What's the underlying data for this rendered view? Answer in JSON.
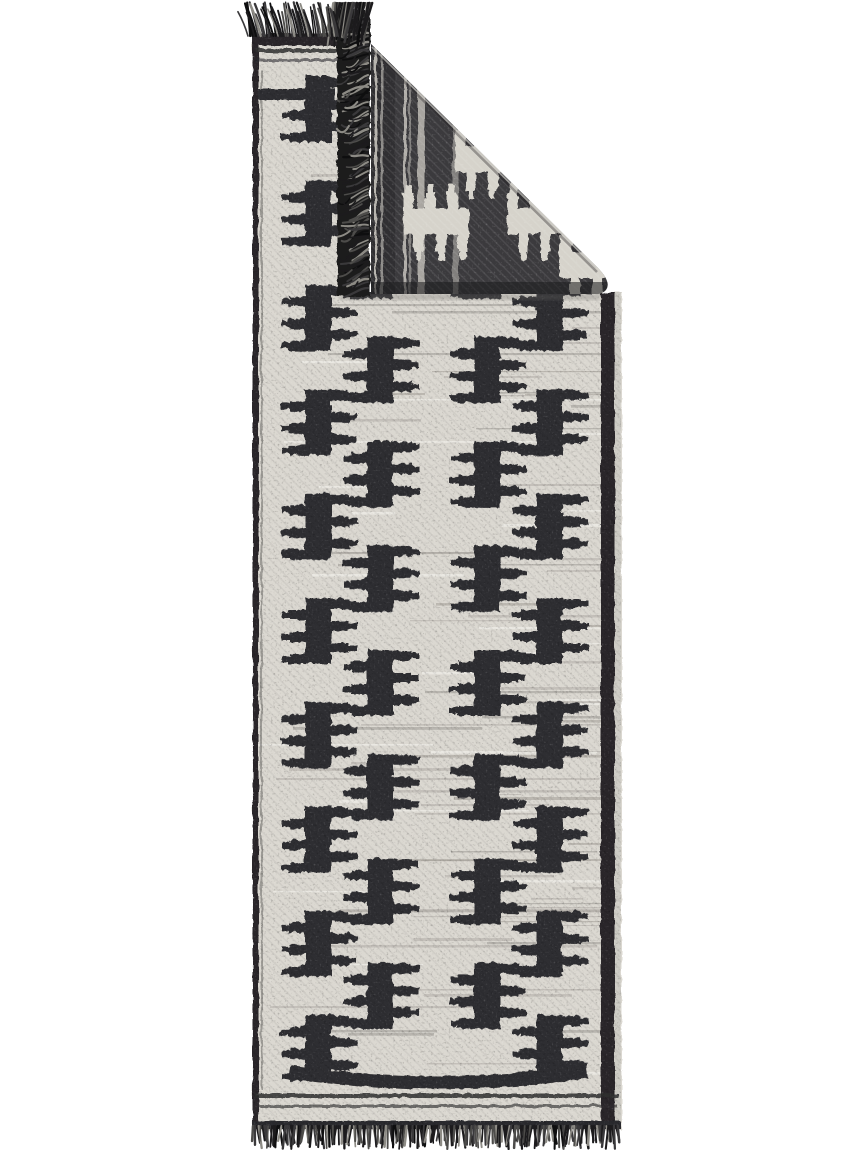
{
  "scene": {
    "type": "product-photo",
    "subject": "Flat-woven black and white kilim runner rug with geometric stepped comb motifs, top corner folded over showing the dark reverse side, fringed ends",
    "background_color": "#ffffff"
  },
  "colors": {
    "front_base": "#dbd8d1",
    "motif_dark": "#2f2e30",
    "back_base": "#3b3a3d",
    "back_shade": "#28272a",
    "back_motif_cream": "#d6d3cb",
    "border_dark": "#29282a",
    "braid_dark": "#2c2b2d",
    "fringe_dark": "#1c1b1d",
    "fringe_mid": "#3a393b",
    "fringe_soft": "#4d4c4a",
    "fringe_light": "#8d8b85",
    "edge_highlight": "#c6c4bf",
    "edge_sliver": "#cfcdc6",
    "streak_grey": "#a8a59d",
    "streak_light": "#f3f1eb",
    "streak_mid": "#8b8880",
    "streak_dark": "#66645f",
    "fold_shadow": "#6b6965"
  },
  "rug": {
    "left": 252,
    "right": 621,
    "top_fabric": 33,
    "bottom_fabric": 1129,
    "left_strip_right": 352,
    "fold": {
      "tip_x": 371,
      "tip_y": 44,
      "hyp_end_x": 597,
      "hyp_end_y": 267,
      "bottom_y": 294,
      "fringe_band": {
        "x": 336,
        "y": 9,
        "w": 33,
        "h": 286
      }
    },
    "borders": {
      "left_w": 6,
      "right_x": 600,
      "right_w": 14,
      "top_selvedge": {
        "y": 33,
        "h": 12
      },
      "top_lines": [
        [
          48,
          4
        ],
        [
          58,
          3
        ]
      ],
      "top_bar": {
        "x": 258,
        "y": 88,
        "w": 76,
        "h": 11
      },
      "bottom_bar": {
        "x1": 289,
        "y1": 1071,
        "cx": 437,
        "cy": 1093,
        "x2": 586,
        "w": 13
      },
      "bottom_lines": [
        [
          1093,
          4
        ],
        [
          1104,
          3
        ]
      ],
      "braid": {
        "y": 1120,
        "h": 9
      }
    }
  },
  "pattern": {
    "motif": {
      "width": 80,
      "height": 66
    },
    "columns": [
      278,
      340,
      447,
      509
    ],
    "row_pitch": 104.3,
    "outer_rows": {
      "start": 75,
      "count": 10,
      "columns": [
        0,
        3
      ]
    },
    "inner_rows": {
      "start": 127,
      "count": 9,
      "columns": [
        1,
        2
      ]
    },
    "field_clip": {
      "x": 256,
      "y": 62,
      "w": 354,
      "h": 1022
    },
    "back_motifs": [
      [
        435,
        221
      ],
      [
        539,
        221
      ],
      [
        487,
        159
      ],
      [
        591,
        265
      ]
    ],
    "back_streaks": [
      [
        374,
        2,
        0.8
      ],
      [
        380,
        2.5,
        0.55
      ],
      [
        403,
        3,
        0.75
      ],
      [
        408,
        2,
        0.45
      ],
      [
        417,
        7,
        0.7
      ],
      [
        452,
        6,
        0.45
      ]
    ]
  },
  "texture": {
    "seed": 7,
    "h_streaks": 110,
    "fringe_top": {
      "x0": 248,
      "x1": 342,
      "step": 1.6,
      "y": 36,
      "len_min": 22,
      "len_max": 34,
      "lean_min": -11,
      "lean_max": -3
    },
    "fringe_bottom": {
      "x0": 253,
      "x1": 618,
      "step": 1.9,
      "y": 1126,
      "len_min": 14,
      "len_max": 23
    },
    "fringe_fold": {
      "x": 368,
      "y0": 12,
      "y1": 290,
      "step": 3.0
    },
    "fringe_corner": {
      "x0": 333,
      "x1": 373,
      "step": 1.4,
      "y": 3
    }
  }
}
